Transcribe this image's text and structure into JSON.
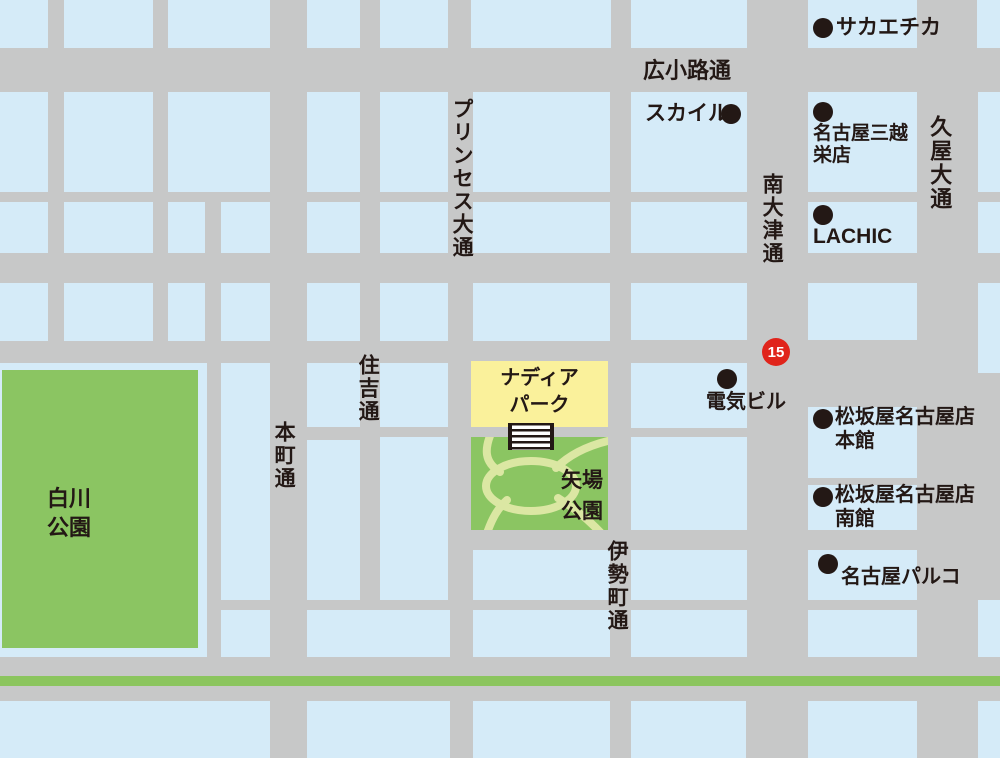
{
  "map": {
    "colors": {
      "road": "#c7c8c8",
      "block": "#d5ebf8",
      "park_green": "#8bc562",
      "path_green": "#dbe7a3",
      "nadia_yellow": "#faf19b",
      "median_green": "#8bc55e",
      "ink": "#231815",
      "badge_red": "#e0241b",
      "white": "#ffffff"
    },
    "route_badge": {
      "number": "15"
    },
    "streets": [
      {
        "id": "hirokoji",
        "name": "広小路通",
        "x": 643,
        "y": 58,
        "orientation": "horizontal",
        "size": 22
      },
      {
        "id": "princess",
        "name": "プリンセス大通",
        "x": 449,
        "y": 98,
        "orientation": "vertical",
        "size": 21
      },
      {
        "id": "sumiyoshi",
        "name": "住吉通",
        "x": 355,
        "y": 354,
        "orientation": "vertical",
        "size": 21
      },
      {
        "id": "honmachi",
        "name": "本町通",
        "x": 271,
        "y": 421,
        "orientation": "vertical",
        "size": 21
      },
      {
        "id": "isemachi",
        "name": "伊勢町通",
        "x": 604,
        "y": 540,
        "orientation": "vertical",
        "size": 21
      },
      {
        "id": "minami-otsu",
        "name": "南大津通",
        "x": 759,
        "y": 173,
        "orientation": "vertical",
        "size": 21
      },
      {
        "id": "hisaya",
        "name": "久屋大通",
        "x": 927,
        "y": 115,
        "orientation": "vertical",
        "size": 22
      }
    ],
    "landmarks": [
      {
        "id": "sakaechika",
        "lines": [
          "サカエチカ"
        ],
        "dot": {
          "x": 823,
          "y": 28,
          "r": 10
        },
        "text": {
          "x": 836,
          "y": 16,
          "size": 21,
          "lh": 24
        }
      },
      {
        "id": "skyle",
        "lines": [
          "スカイル"
        ],
        "dot": {
          "x": 731,
          "y": 114,
          "r": 10
        },
        "text": {
          "x": 645,
          "y": 102,
          "size": 21,
          "lh": 24
        }
      },
      {
        "id": "mitsukoshi",
        "lines": [
          "名古屋三越",
          "栄店"
        ],
        "dot": {
          "x": 823,
          "y": 112,
          "r": 10
        },
        "text": {
          "x": 813,
          "y": 123,
          "size": 19,
          "lh": 22
        }
      },
      {
        "id": "lachic",
        "lines": [
          "LACHIC"
        ],
        "dot": {
          "x": 823,
          "y": 215,
          "r": 10
        },
        "text": {
          "x": 813,
          "y": 225,
          "size": 21,
          "lh": 24
        }
      },
      {
        "id": "denki-bldg",
        "lines": [
          "電気ビル"
        ],
        "dot": {
          "x": 727,
          "y": 379,
          "r": 10
        },
        "text": {
          "x": 706,
          "y": 391,
          "size": 20,
          "lh": 23
        }
      },
      {
        "id": "matsuzakaya-honkan",
        "lines": [
          "松坂屋名古屋店",
          "本館"
        ],
        "dot": {
          "x": 823,
          "y": 419,
          "r": 10
        },
        "text": {
          "x": 835,
          "y": 405,
          "size": 20,
          "lh": 24
        }
      },
      {
        "id": "matsuzakaya-nankan",
        "lines": [
          "松坂屋名古屋店",
          "南館"
        ],
        "dot": {
          "x": 823,
          "y": 497,
          "r": 10
        },
        "text": {
          "x": 835,
          "y": 483,
          "size": 20,
          "lh": 24
        }
      },
      {
        "id": "nagoya-parco",
        "lines": [
          "名古屋パルコ"
        ],
        "dot": {
          "x": 828,
          "y": 564,
          "r": 10
        },
        "text": {
          "x": 841,
          "y": 566,
          "size": 20,
          "lh": 23
        }
      }
    ],
    "park_labels": [
      {
        "id": "shirakawa-park",
        "lines": [
          "白川",
          "公園"
        ],
        "x": 47,
        "y": 484,
        "size": 22,
        "lh": 29,
        "align": "left",
        "width": null
      },
      {
        "id": "yaba-park",
        "lines": [
          "矢場",
          "公園"
        ],
        "x": 561,
        "y": 465,
        "size": 21,
        "lh": 31,
        "align": "left",
        "width": null
      },
      {
        "id": "nadia-park",
        "lines": [
          "ナディア",
          "パーク"
        ],
        "x": 471,
        "y": 365,
        "size": 20,
        "lh": 27,
        "align": "center",
        "width": 137
      }
    ],
    "blocks": [
      [
        0,
        0,
        48,
        48
      ],
      [
        64,
        0,
        89,
        48
      ],
      [
        168,
        0,
        102,
        48
      ],
      [
        307,
        0,
        53,
        48
      ],
      [
        380,
        0,
        68,
        48
      ],
      [
        471,
        0,
        140,
        48
      ],
      [
        631,
        0,
        116,
        48
      ],
      [
        808,
        0,
        109,
        48
      ],
      [
        977,
        0,
        23,
        48
      ],
      [
        0,
        92,
        48,
        100
      ],
      [
        64,
        92,
        89,
        100
      ],
      [
        168,
        92,
        102,
        100
      ],
      [
        307,
        92,
        53,
        100
      ],
      [
        380,
        92,
        68,
        100
      ],
      [
        473,
        92,
        137,
        100
      ],
      [
        631,
        92,
        116,
        100
      ],
      [
        808,
        92,
        109,
        100
      ],
      [
        978,
        92,
        22,
        100
      ],
      [
        0,
        202,
        48,
        51
      ],
      [
        64,
        202,
        89,
        51
      ],
      [
        168,
        202,
        37,
        51
      ],
      [
        221,
        202,
        49,
        51
      ],
      [
        307,
        202,
        53,
        51
      ],
      [
        380,
        202,
        68,
        51
      ],
      [
        473,
        202,
        137,
        51
      ],
      [
        631,
        202,
        116,
        51
      ],
      [
        808,
        202,
        109,
        51
      ],
      [
        978,
        202,
        22,
        51
      ],
      [
        0,
        283,
        48,
        58
      ],
      [
        64,
        283,
        89,
        58
      ],
      [
        168,
        283,
        37,
        58
      ],
      [
        221,
        283,
        49,
        58
      ],
      [
        307,
        283,
        53,
        58
      ],
      [
        380,
        283,
        68,
        58
      ],
      [
        473,
        283,
        137,
        58
      ],
      [
        631,
        283,
        116,
        57
      ],
      [
        808,
        283,
        109,
        57
      ],
      [
        978,
        283,
        22,
        90
      ],
      [
        0,
        363,
        207,
        294
      ],
      [
        221,
        363,
        49,
        237
      ],
      [
        307,
        363,
        53,
        64
      ],
      [
        380,
        363,
        68,
        64
      ],
      [
        631,
        363,
        116,
        65
      ],
      [
        808,
        407,
        109,
        71
      ],
      [
        307,
        440,
        53,
        160
      ],
      [
        380,
        437,
        68,
        163
      ],
      [
        631,
        437,
        116,
        93
      ],
      [
        808,
        485,
        109,
        45
      ],
      [
        473,
        550,
        137,
        50
      ],
      [
        631,
        550,
        116,
        50
      ],
      [
        808,
        550,
        109,
        50
      ],
      [
        221,
        610,
        49,
        47
      ],
      [
        307,
        610,
        143,
        47
      ],
      [
        473,
        610,
        137,
        47
      ],
      [
        631,
        610,
        116,
        47
      ],
      [
        808,
        610,
        109,
        47
      ],
      [
        978,
        600,
        22,
        57
      ],
      [
        0,
        701,
        270,
        57
      ],
      [
        307,
        701,
        143,
        57
      ],
      [
        473,
        701,
        137,
        57
      ],
      [
        631,
        701,
        115,
        57
      ],
      [
        808,
        701,
        109,
        57
      ],
      [
        978,
        701,
        22,
        57
      ]
    ]
  }
}
